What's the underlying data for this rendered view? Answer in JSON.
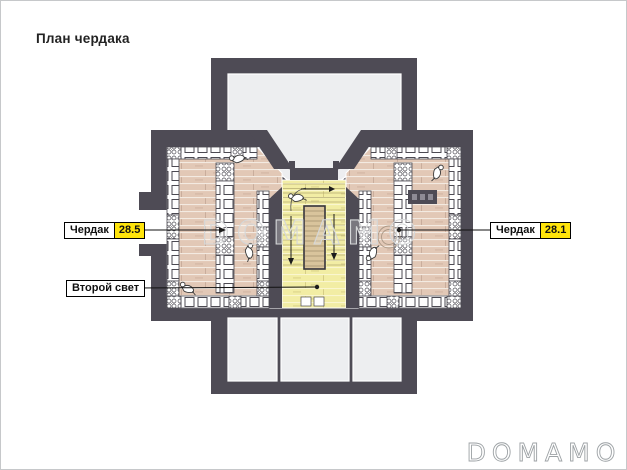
{
  "page": {
    "title": "План чердака"
  },
  "plan": {
    "room_labels": {
      "left": {
        "name": "Чердак",
        "area": "28.5"
      },
      "right": {
        "name": "Чердак",
        "area": "28.1"
      },
      "second_light": {
        "name": "Второй свет"
      }
    }
  },
  "watermark_text": "DOMAMO",
  "logo_text": "DOMAMO",
  "colors": {
    "wall": "#4e4b55",
    "interior-gray": "#edeef0",
    "wood-floor": "#e2c8b6",
    "wood-line": "#f3eae1",
    "wood-joint": "#c9ad9c",
    "yellow-floor": "#f2eda4",
    "yellow-line": "#d6cd85",
    "stair-core": "#d9c49c",
    "label-yellow": "#ffe40b",
    "furniture-outline": "#4c4a52",
    "leader": "#111111",
    "watermark": "#d5d7d8",
    "logo": "#9da2a5"
  }
}
